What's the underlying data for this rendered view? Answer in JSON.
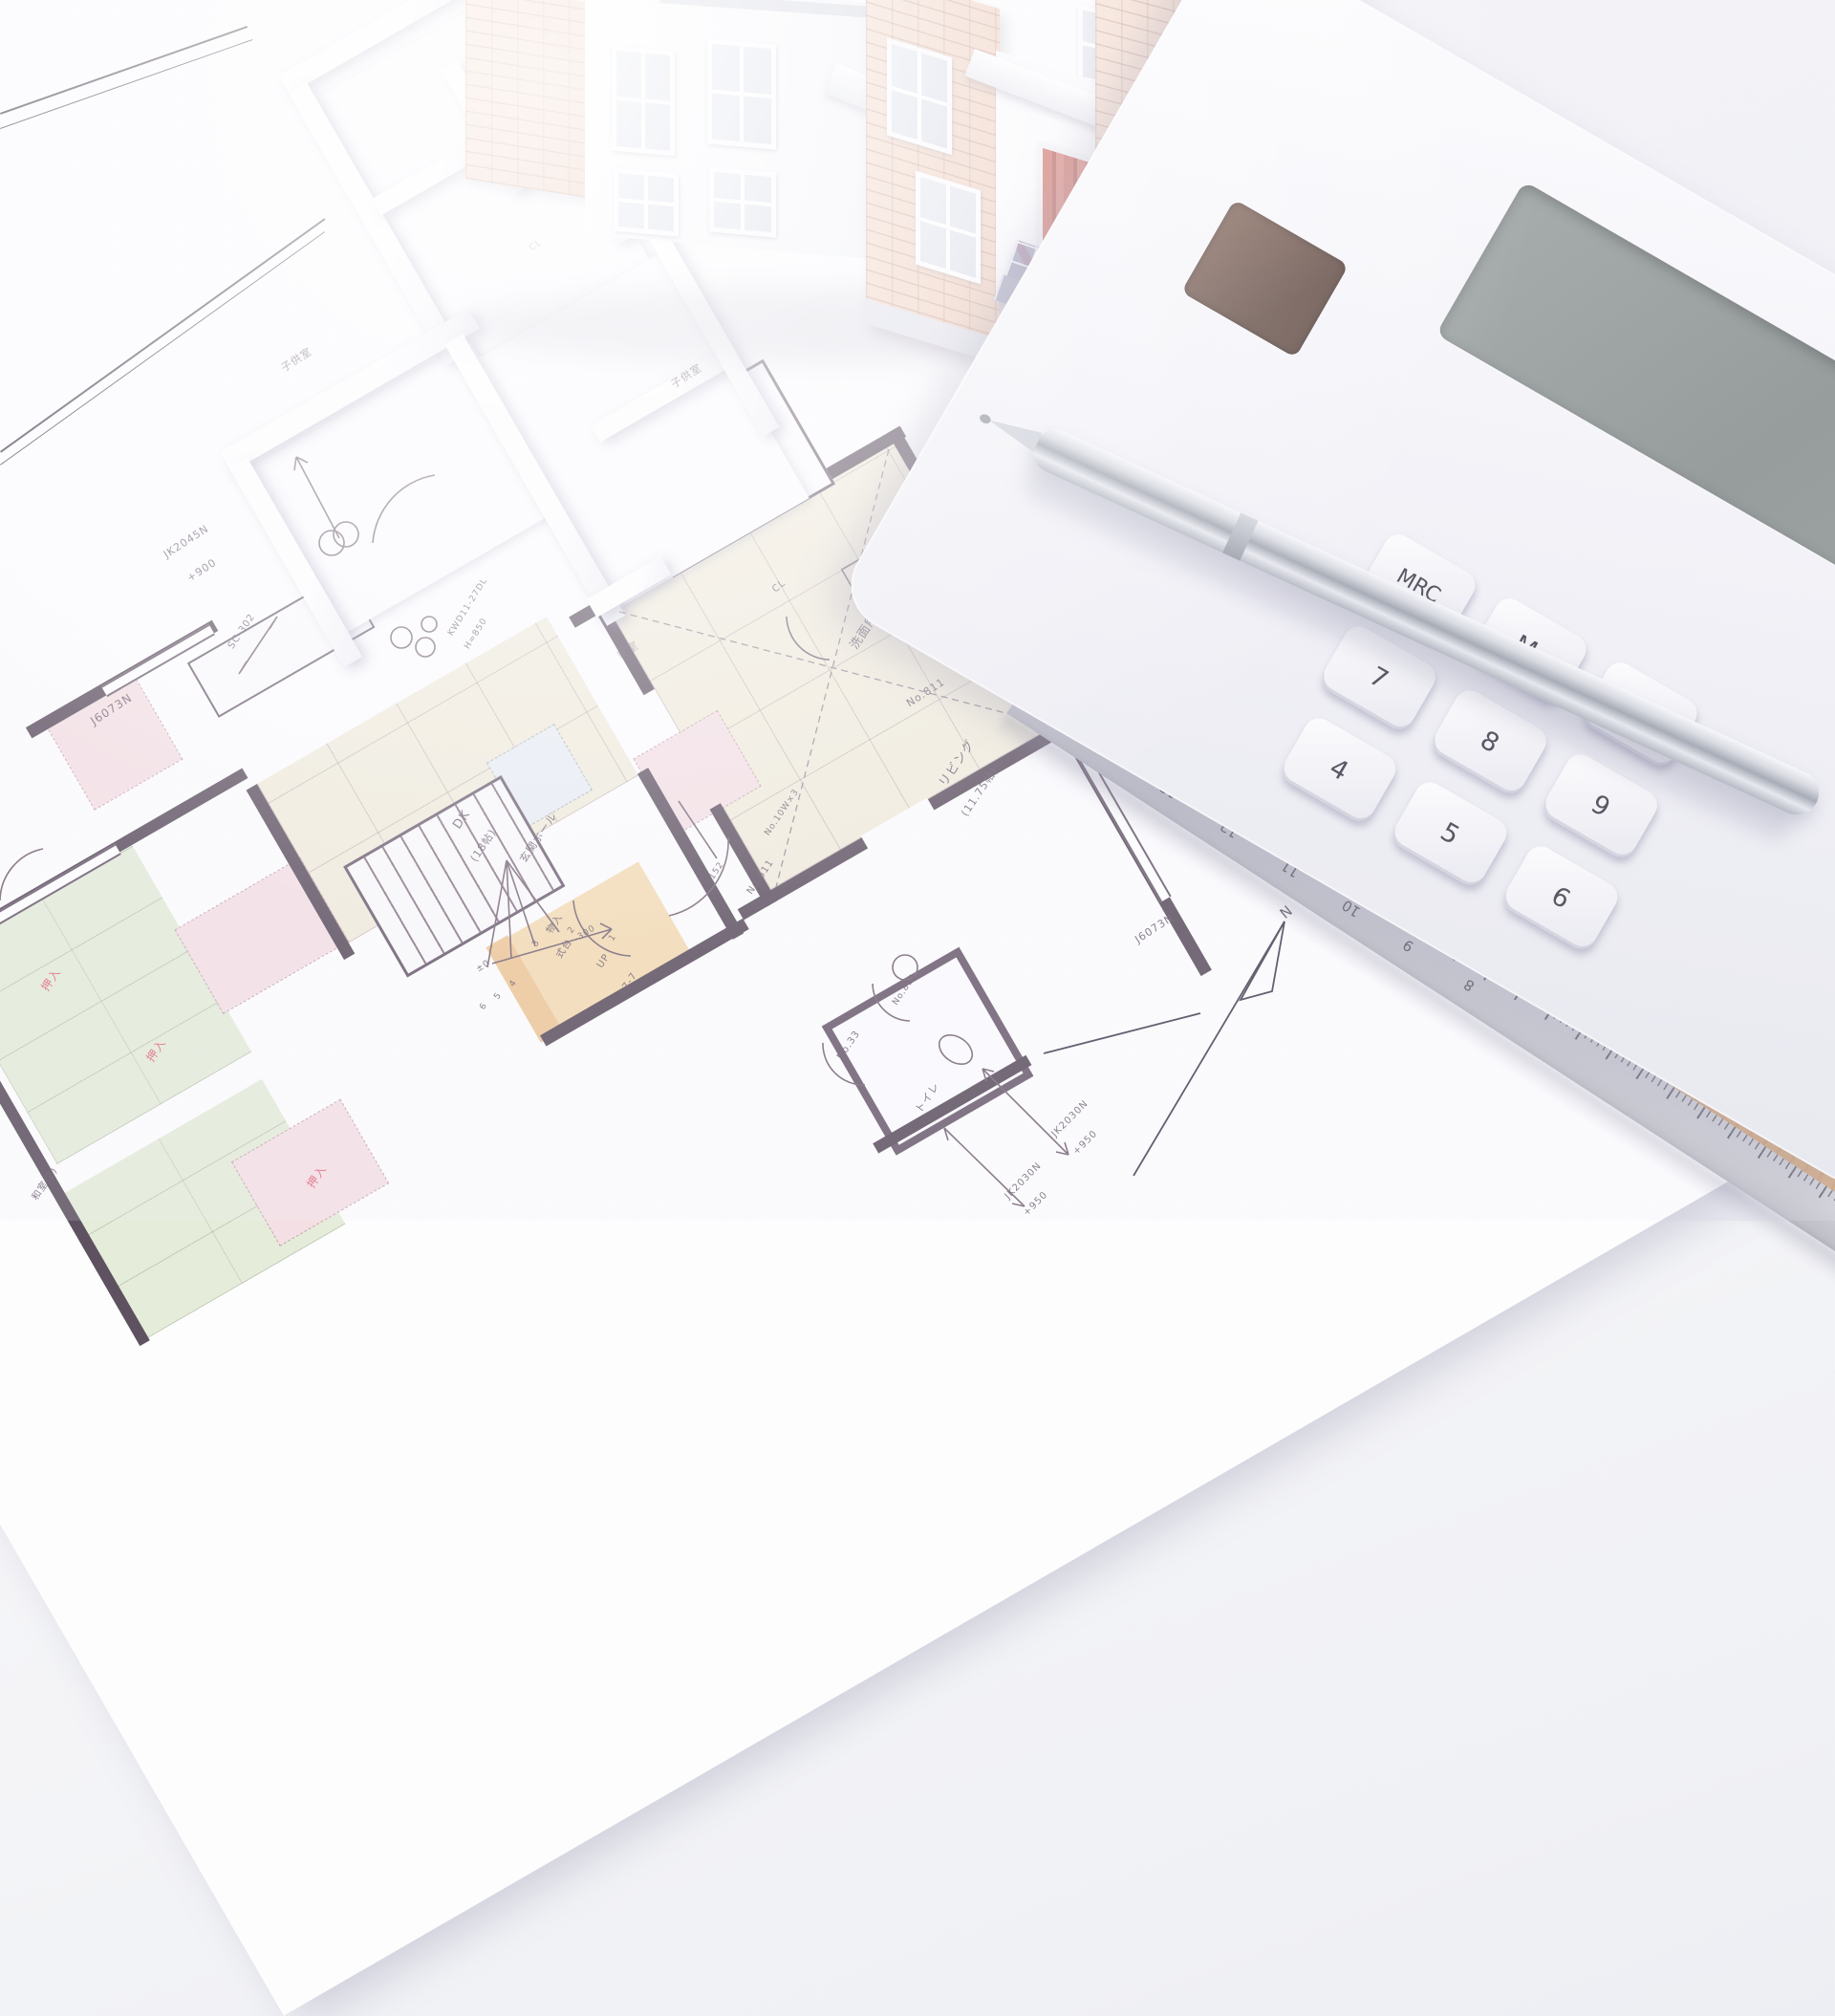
{
  "scene": {
    "description": "Photograph: Japanese architectural floor plan (blueprint) on a desk with a white scale model house, foam interior model, silver ballpoint pen, wooden scale ruler and white calculator."
  },
  "colors": {
    "wall": "#5e5160",
    "beige_room": "#f1ecdc",
    "green_room": "#e5edda",
    "pink_closet": "#f4e0e4",
    "orange_entry": "#f4dcb4",
    "tile_blue": "#8f90ad",
    "brick": "#ecc8b2",
    "red_label": "#e26178",
    "door_red": "#c4574a"
  },
  "labels": [
    {
      "text": "JK2045N"
    },
    {
      "text": "+900"
    },
    {
      "text": "J6073N"
    },
    {
      "text": "SC-302"
    },
    {
      "text": "KWD11-27DL"
    },
    {
      "text": "H=850"
    },
    {
      "text": "J4515"
    },
    {
      "text": "+1950"
    },
    {
      "text": "洗面所"
    },
    {
      "text": "洗濯パン"
    },
    {
      "text": "No.811"
    },
    {
      "text": "リビング"
    },
    {
      "text": "(11.75帖)"
    },
    {
      "text": "DK"
    },
    {
      "text": "(18帖)"
    },
    {
      "text": "CL"
    },
    {
      "text": "CL"
    },
    {
      "text": "子供室"
    },
    {
      "text": "子供室"
    },
    {
      "text": "寝室"
    },
    {
      "text": "No.611"
    },
    {
      "text": "No.10W×3"
    },
    {
      "text": "UP"
    },
    {
      "text": "17-7"
    },
    {
      "text": "物入"
    },
    {
      "text": "玄関ホール"
    },
    {
      "text": "式台"
    },
    {
      "text": "±0"
    },
    {
      "text": "-300"
    },
    {
      "text": "152"
    },
    {
      "text": "No.33"
    },
    {
      "text": "トイレ"
    },
    {
      "text": "押入"
    },
    {
      "text": "押入"
    },
    {
      "text": "押入"
    },
    {
      "text": "和室(2)"
    },
    {
      "text": "J6073N"
    },
    {
      "text": "JK2030N"
    },
    {
      "text": "+950"
    },
    {
      "text": "JK2030N"
    },
    {
      "text": "+950"
    },
    {
      "text": "N"
    },
    {
      "text": "No.811"
    },
    {
      "text": "1"
    },
    {
      "text": "2"
    },
    {
      "text": "3"
    },
    {
      "text": "4"
    },
    {
      "text": "5"
    },
    {
      "text": "6"
    }
  ],
  "calculator": {
    "keys": [
      "MRC",
      "M-",
      "M+",
      "7",
      "8",
      "9",
      "4",
      "5",
      "6"
    ]
  },
  "ruler": {
    "top_scale": [
      "0",
      "1",
      "2",
      "3",
      "4",
      "5",
      "6"
    ],
    "bottom_scale": [
      "15",
      "14",
      "13",
      "12",
      "11",
      "10",
      "9",
      "8"
    ]
  }
}
